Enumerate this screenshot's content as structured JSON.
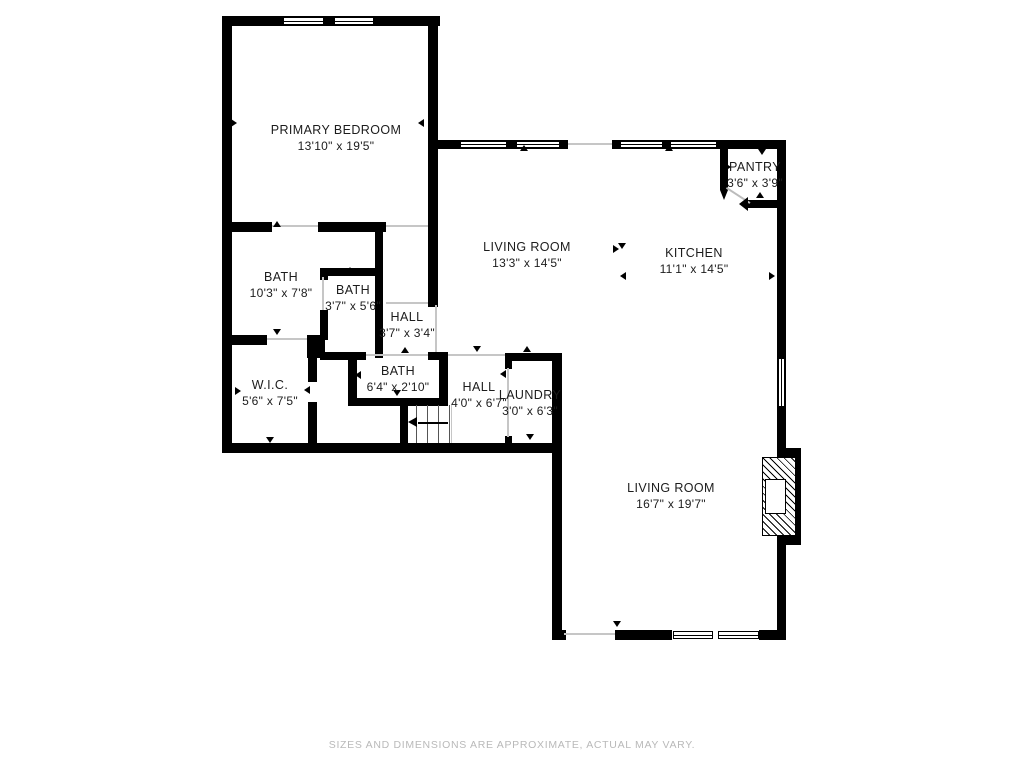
{
  "footer": {
    "disclaimer": "SIZES AND DIMENSIONS ARE APPROXIMATE, ACTUAL MAY VARY."
  },
  "rooms": [
    {
      "id": "primary-bedroom",
      "name": "PRIMARY BEDROOM",
      "dims": "13'10\" x 19'5\"",
      "cx": 336,
      "cy": 138
    },
    {
      "id": "living-room-upper",
      "name": "LIVING ROOM",
      "dims": "13'3\" x 14'5\"",
      "cx": 527,
      "cy": 255
    },
    {
      "id": "kitchen",
      "name": "KITCHEN",
      "dims": "11'1\" x 14'5\"",
      "cx": 694,
      "cy": 261
    },
    {
      "id": "pantry",
      "name": "PANTRY",
      "dims": "3'6\" x 3'9\"",
      "cx": 755,
      "cy": 175
    },
    {
      "id": "bath-1",
      "name": "BATH",
      "dims": "10'3\" x 7'8\"",
      "cx": 281,
      "cy": 285
    },
    {
      "id": "bath-2",
      "name": "BATH",
      "dims": "3'7\" x 5'6\"",
      "cx": 353,
      "cy": 298
    },
    {
      "id": "hall-1",
      "name": "HALL",
      "dims": "3'7\" x 3'4\"",
      "cx": 407,
      "cy": 325
    },
    {
      "id": "bath-3",
      "name": "BATH",
      "dims": "6'4\" x 2'10\"",
      "cx": 398,
      "cy": 379
    },
    {
      "id": "wic",
      "name": "W.I.C.",
      "dims": "5'6\" x 7'5\"",
      "cx": 270,
      "cy": 393
    },
    {
      "id": "hall-2",
      "name": "HALL",
      "dims": "4'0\" x 6'7\"",
      "cx": 479,
      "cy": 395
    },
    {
      "id": "laundry",
      "name": "LAUNDRY",
      "dims": "3'0\" x 6'3\"",
      "cx": 530,
      "cy": 403
    },
    {
      "id": "living-room-lower",
      "name": "LIVING ROOM",
      "dims": "16'7\" x 19'7\"",
      "cx": 671,
      "cy": 496
    }
  ],
  "plan": {
    "wall_color": "#000000",
    "opening_color": "#c6c6c6",
    "walls": [
      [
        222,
        16,
        218,
        10
      ],
      [
        222,
        16,
        10,
        437
      ],
      [
        428,
        16,
        10,
        291
      ],
      [
        222,
        222,
        50,
        10
      ],
      [
        318,
        222,
        68,
        10
      ],
      [
        375,
        230,
        8,
        128
      ],
      [
        320,
        268,
        55,
        8
      ],
      [
        320,
        268,
        8,
        12
      ],
      [
        320,
        310,
        8,
        30
      ],
      [
        307,
        335,
        18,
        23
      ],
      [
        222,
        335,
        45,
        10
      ],
      [
        308,
        358,
        9,
        24
      ],
      [
        308,
        402,
        9,
        41
      ],
      [
        320,
        352,
        46,
        8
      ],
      [
        428,
        352,
        20,
        8
      ],
      [
        348,
        352,
        9,
        53
      ],
      [
        439,
        352,
        9,
        53
      ],
      [
        348,
        398,
        100,
        8
      ],
      [
        400,
        405,
        8,
        38
      ],
      [
        222,
        443,
        340,
        10
      ],
      [
        505,
        353,
        57,
        8
      ],
      [
        505,
        360,
        7,
        9
      ],
      [
        505,
        436,
        7,
        9
      ],
      [
        552,
        353,
        10,
        287
      ],
      [
        438,
        140,
        130,
        9
      ],
      [
        612,
        140,
        174,
        9
      ],
      [
        777,
        140,
        9,
        500
      ],
      [
        720,
        148,
        8,
        42
      ],
      [
        748,
        200,
        38,
        8
      ],
      [
        552,
        630,
        14,
        10
      ],
      [
        615,
        630,
        57,
        10
      ],
      [
        759,
        630,
        27,
        10
      ],
      [
        785,
        448,
        16,
        97
      ]
    ],
    "windows": [
      {
        "x": 283,
        "y": 17,
        "w": 41,
        "h": 8,
        "o": "h"
      },
      {
        "x": 334,
        "y": 17,
        "w": 40,
        "h": 8,
        "o": "h"
      },
      {
        "x": 460,
        "y": 141,
        "w": 47,
        "h": 7,
        "o": "h"
      },
      {
        "x": 516,
        "y": 141,
        "w": 44,
        "h": 7,
        "o": "h"
      },
      {
        "x": 620,
        "y": 141,
        "w": 43,
        "h": 7,
        "o": "h"
      },
      {
        "x": 670,
        "y": 141,
        "w": 47,
        "h": 7,
        "o": "h"
      },
      {
        "x": 778,
        "y": 358,
        "w": 7,
        "h": 49,
        "o": "v"
      },
      {
        "x": 673,
        "y": 631,
        "w": 40,
        "h": 8,
        "o": "h"
      },
      {
        "x": 718,
        "y": 631,
        "w": 41,
        "h": 8,
        "o": "h"
      }
    ],
    "openings": [
      [
        272,
        225,
        46,
        2
      ],
      [
        386,
        225,
        42,
        2
      ],
      [
        267,
        338,
        40,
        2
      ],
      [
        322,
        277,
        2,
        33
      ],
      [
        366,
        354,
        62,
        2
      ],
      [
        386,
        302,
        42,
        2
      ],
      [
        435,
        305,
        2,
        47
      ],
      [
        448,
        354,
        57,
        2
      ],
      [
        507,
        368,
        2,
        69
      ],
      [
        568,
        143,
        44,
        2
      ],
      [
        564,
        633,
        51,
        2
      ],
      [
        451,
        405,
        1,
        38
      ]
    ],
    "diagonal_door": {
      "x": 727,
      "y": 187,
      "len": 28,
      "angle": 33
    },
    "markers": [
      [
        234,
        123,
        "right"
      ],
      [
        421,
        123,
        "left"
      ],
      [
        277,
        224,
        "up"
      ],
      [
        403,
        22,
        "up"
      ],
      [
        524,
        148,
        "up"
      ],
      [
        669,
        148,
        "up"
      ],
      [
        616,
        249,
        "right"
      ],
      [
        622,
        246,
        "down"
      ],
      [
        623,
        276,
        "left"
      ],
      [
        772,
        276,
        "right"
      ],
      [
        728,
        167,
        "right"
      ],
      [
        779,
        167,
        "left"
      ],
      [
        762,
        152,
        "down"
      ],
      [
        760,
        195,
        "up"
      ],
      [
        350,
        270,
        "up"
      ],
      [
        405,
        350,
        "up"
      ],
      [
        358,
        375,
        "left"
      ],
      [
        442,
        375,
        "right"
      ],
      [
        397,
        393,
        "down"
      ],
      [
        307,
        390,
        "left"
      ],
      [
        238,
        391,
        "right"
      ],
      [
        270,
        440,
        "down"
      ],
      [
        277,
        332,
        "down"
      ],
      [
        477,
        349,
        "down"
      ],
      [
        527,
        349,
        "up"
      ],
      [
        503,
        374,
        "left"
      ],
      [
        530,
        437,
        "down"
      ],
      [
        617,
        624,
        "down"
      ],
      [
        786,
        493,
        "right"
      ]
    ],
    "stairs": {
      "treads": [
        [
          416,
          405,
          1,
          38
        ],
        [
          427,
          405,
          1,
          38
        ],
        [
          438,
          405,
          1,
          38
        ],
        [
          449,
          405,
          1,
          38
        ]
      ],
      "arrow_shaft": [
        418,
        422,
        30,
        2
      ],
      "arrow_head": {
        "x": 408,
        "y": 417
      }
    },
    "fireplace": {
      "hatch": [
        762,
        457,
        34,
        79
      ],
      "firebox": [
        765,
        479,
        21,
        35
      ]
    },
    "tips": [
      {
        "type": "down",
        "x": 720,
        "y": 190,
        "bw": 4,
        "bl": 10
      },
      {
        "type": "left",
        "x": 739,
        "y": 197,
        "bw": 7,
        "bl": 9
      }
    ]
  }
}
